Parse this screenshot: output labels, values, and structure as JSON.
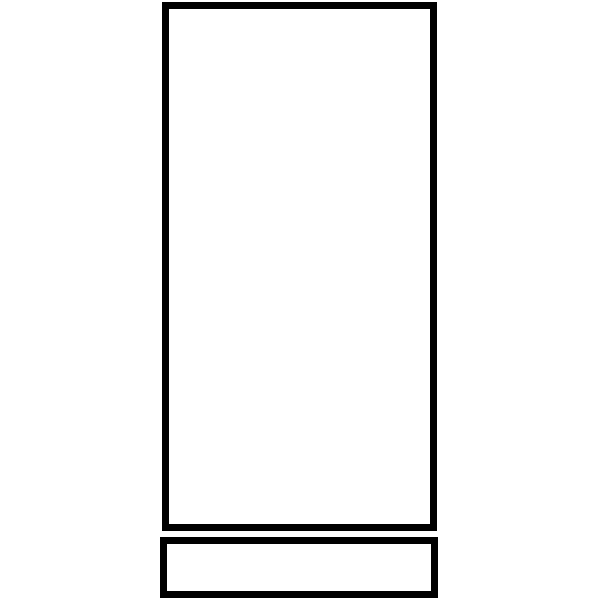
{
  "canvas": {
    "width": 600,
    "height": 600,
    "background": "#ffffff"
  },
  "stroke_color": "#000000",
  "shapes": [
    {
      "name": "tall-rectangle-outline",
      "x": 162,
      "y": 2,
      "width": 275,
      "height": 529,
      "stroke_width": 7,
      "stroke_color": "#000000",
      "fill": "#ffffff"
    },
    {
      "name": "base-rectangle-outline",
      "x": 160,
      "y": 537,
      "width": 278,
      "height": 61,
      "stroke_width": 7,
      "stroke_color": "#000000",
      "fill": "#ffffff"
    }
  ]
}
